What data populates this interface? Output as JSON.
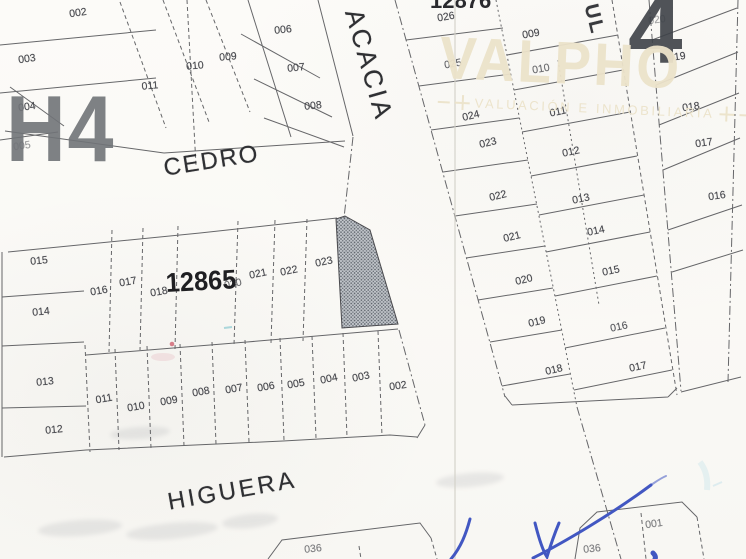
{
  "map": {
    "streets": {
      "cedro": "CEDRO",
      "acacia": "ACACIA",
      "higuera": "HIGUERA",
      "partial_street": "UL"
    },
    "zone_labels": {
      "left": "H4",
      "right": "4"
    },
    "block_ids": {
      "center_block": "12865",
      "top_block": "12876"
    },
    "watermark": {
      "brand": "VALPHO",
      "tagline": "VALUACIÓN  E  INMOBILIARIA"
    },
    "colors": {
      "line": "#46474b",
      "label": "#4a4b50",
      "watermark": "#ece3ca",
      "signature": "#4257c2",
      "highlight_fill": "#c2c6cb",
      "highlight_dots": "#585e66"
    },
    "blocks": [
      {
        "id": "top-left-block",
        "lots": [
          {
            "label": "002",
            "x": 78,
            "y": 13,
            "r": -8,
            "o": 1
          },
          {
            "label": "003",
            "x": 27,
            "y": 59,
            "r": -8,
            "o": 1
          },
          {
            "label": "004",
            "x": 27,
            "y": 107,
            "r": -8,
            "o": 1
          },
          {
            "label": "005",
            "x": 22,
            "y": 146,
            "r": -8,
            "o": 0.55
          }
        ]
      },
      {
        "id": "top-middle-strips",
        "lots": [
          {
            "label": "011",
            "x": 150,
            "y": 86,
            "r": -5,
            "o": 1
          },
          {
            "label": "010",
            "x": 195,
            "y": 66,
            "r": -5,
            "o": 1
          },
          {
            "label": "009",
            "x": 228,
            "y": 57,
            "r": -5,
            "o": 1
          }
        ]
      },
      {
        "id": "top-middle-row",
        "lots": [
          {
            "label": "006",
            "x": 283,
            "y": 30,
            "r": -6,
            "o": 1
          },
          {
            "label": "007",
            "x": 296,
            "y": 68,
            "r": -6,
            "o": 1
          },
          {
            "label": "008",
            "x": 313,
            "y": 106,
            "r": -6,
            "o": 1
          }
        ]
      },
      {
        "id": "center-block-west-column",
        "lots": [
          {
            "label": "015",
            "x": 39,
            "y": 261,
            "r": -6,
            "o": 1
          },
          {
            "label": "014",
            "x": 41,
            "y": 312,
            "r": -6,
            "o": 1
          },
          {
            "label": "013",
            "x": 45,
            "y": 382,
            "r": -6,
            "o": 1
          },
          {
            "label": "012",
            "x": 54,
            "y": 430,
            "r": -6,
            "o": 1
          }
        ]
      },
      {
        "id": "center-block-north-row",
        "lots": [
          {
            "label": "016",
            "x": 99,
            "y": 291,
            "r": -10,
            "o": 1
          },
          {
            "label": "017",
            "x": 128,
            "y": 282,
            "r": -10,
            "o": 1
          },
          {
            "label": "018",
            "x": 159,
            "y": 292,
            "r": -10,
            "o": 1
          },
          {
            "label": "020",
            "x": 233,
            "y": 284,
            "r": -12,
            "o": 0.8
          },
          {
            "label": "021",
            "x": 258,
            "y": 274,
            "r": -12,
            "o": 1
          },
          {
            "label": "022",
            "x": 289,
            "y": 271,
            "r": -12,
            "o": 1
          },
          {
            "label": "023",
            "x": 324,
            "y": 262,
            "r": -12,
            "o": 1
          }
        ]
      },
      {
        "id": "center-block-south-row",
        "lots": [
          {
            "label": "011",
            "x": 104,
            "y": 399,
            "r": -10,
            "o": 1
          },
          {
            "label": "010",
            "x": 136,
            "y": 407,
            "r": -10,
            "o": 1
          },
          {
            "label": "009",
            "x": 169,
            "y": 401,
            "r": -10,
            "o": 1
          },
          {
            "label": "008",
            "x": 201,
            "y": 392,
            "r": -10,
            "o": 1
          },
          {
            "label": "007",
            "x": 234,
            "y": 389,
            "r": -10,
            "o": 1
          },
          {
            "label": "006",
            "x": 266,
            "y": 387,
            "r": -10,
            "o": 1
          },
          {
            "label": "005",
            "x": 296,
            "y": 384,
            "r": -10,
            "o": 1
          },
          {
            "label": "004",
            "x": 329,
            "y": 379,
            "r": -12,
            "o": 1
          },
          {
            "label": "003",
            "x": 361,
            "y": 377,
            "r": -12,
            "o": 1
          },
          {
            "label": "002",
            "x": 398,
            "y": 386,
            "r": -8,
            "o": 1
          }
        ]
      },
      {
        "id": "east-block-west-column",
        "lots": [
          {
            "label": "026",
            "x": 446,
            "y": 17,
            "r": -10,
            "o": 1
          },
          {
            "label": "025",
            "x": 453,
            "y": 64,
            "r": -10,
            "o": 0.85
          },
          {
            "label": "024",
            "x": 471,
            "y": 116,
            "r": -14,
            "o": 1
          },
          {
            "label": "023",
            "x": 488,
            "y": 143,
            "r": -14,
            "o": 1
          },
          {
            "label": "022",
            "x": 498,
            "y": 196,
            "r": -14,
            "o": 1
          },
          {
            "label": "021",
            "x": 512,
            "y": 237,
            "r": -14,
            "o": 1
          },
          {
            "label": "020",
            "x": 524,
            "y": 280,
            "r": -14,
            "o": 1
          },
          {
            "label": "019",
            "x": 537,
            "y": 322,
            "r": -14,
            "o": 1
          },
          {
            "label": "018",
            "x": 554,
            "y": 370,
            "r": -14,
            "o": 1
          }
        ]
      },
      {
        "id": "east-block-east-column",
        "lots": [
          {
            "label": "009",
            "x": 531,
            "y": 34,
            "r": -10,
            "o": 1
          },
          {
            "label": "010",
            "x": 541,
            "y": 69,
            "r": -10,
            "o": 0.8
          },
          {
            "label": "011",
            "x": 558,
            "y": 112,
            "r": -12,
            "o": 1
          },
          {
            "label": "012",
            "x": 571,
            "y": 152,
            "r": -12,
            "o": 1
          },
          {
            "label": "013",
            "x": 581,
            "y": 199,
            "r": -12,
            "o": 1
          },
          {
            "label": "014",
            "x": 596,
            "y": 231,
            "r": -12,
            "o": 1
          },
          {
            "label": "015",
            "x": 611,
            "y": 271,
            "r": -12,
            "o": 1
          },
          {
            "label": "016",
            "x": 619,
            "y": 327,
            "r": -12,
            "o": 0.9
          },
          {
            "label": "017",
            "x": 638,
            "y": 367,
            "r": -12,
            "o": 1
          }
        ]
      },
      {
        "id": "far-east-column",
        "lots": [
          {
            "label": "020",
            "x": 657,
            "y": 20,
            "r": -8,
            "o": 0.5
          },
          {
            "label": "019",
            "x": 677,
            "y": 57,
            "r": -8,
            "o": 1
          },
          {
            "label": "018",
            "x": 691,
            "y": 107,
            "r": -8,
            "o": 1
          },
          {
            "label": "017",
            "x": 704,
            "y": 143,
            "r": -8,
            "o": 1
          },
          {
            "label": "016",
            "x": 717,
            "y": 196,
            "r": -8,
            "o": 1
          }
        ]
      },
      {
        "id": "south-lots",
        "lots": [
          {
            "label": "036",
            "x": 313,
            "y": 549,
            "r": -6,
            "o": 0.7
          },
          {
            "label": "036",
            "x": 592,
            "y": 549,
            "r": -6,
            "o": 0.7
          },
          {
            "label": "001",
            "x": 654,
            "y": 524,
            "r": -8,
            "o": 0.7
          }
        ]
      }
    ]
  }
}
